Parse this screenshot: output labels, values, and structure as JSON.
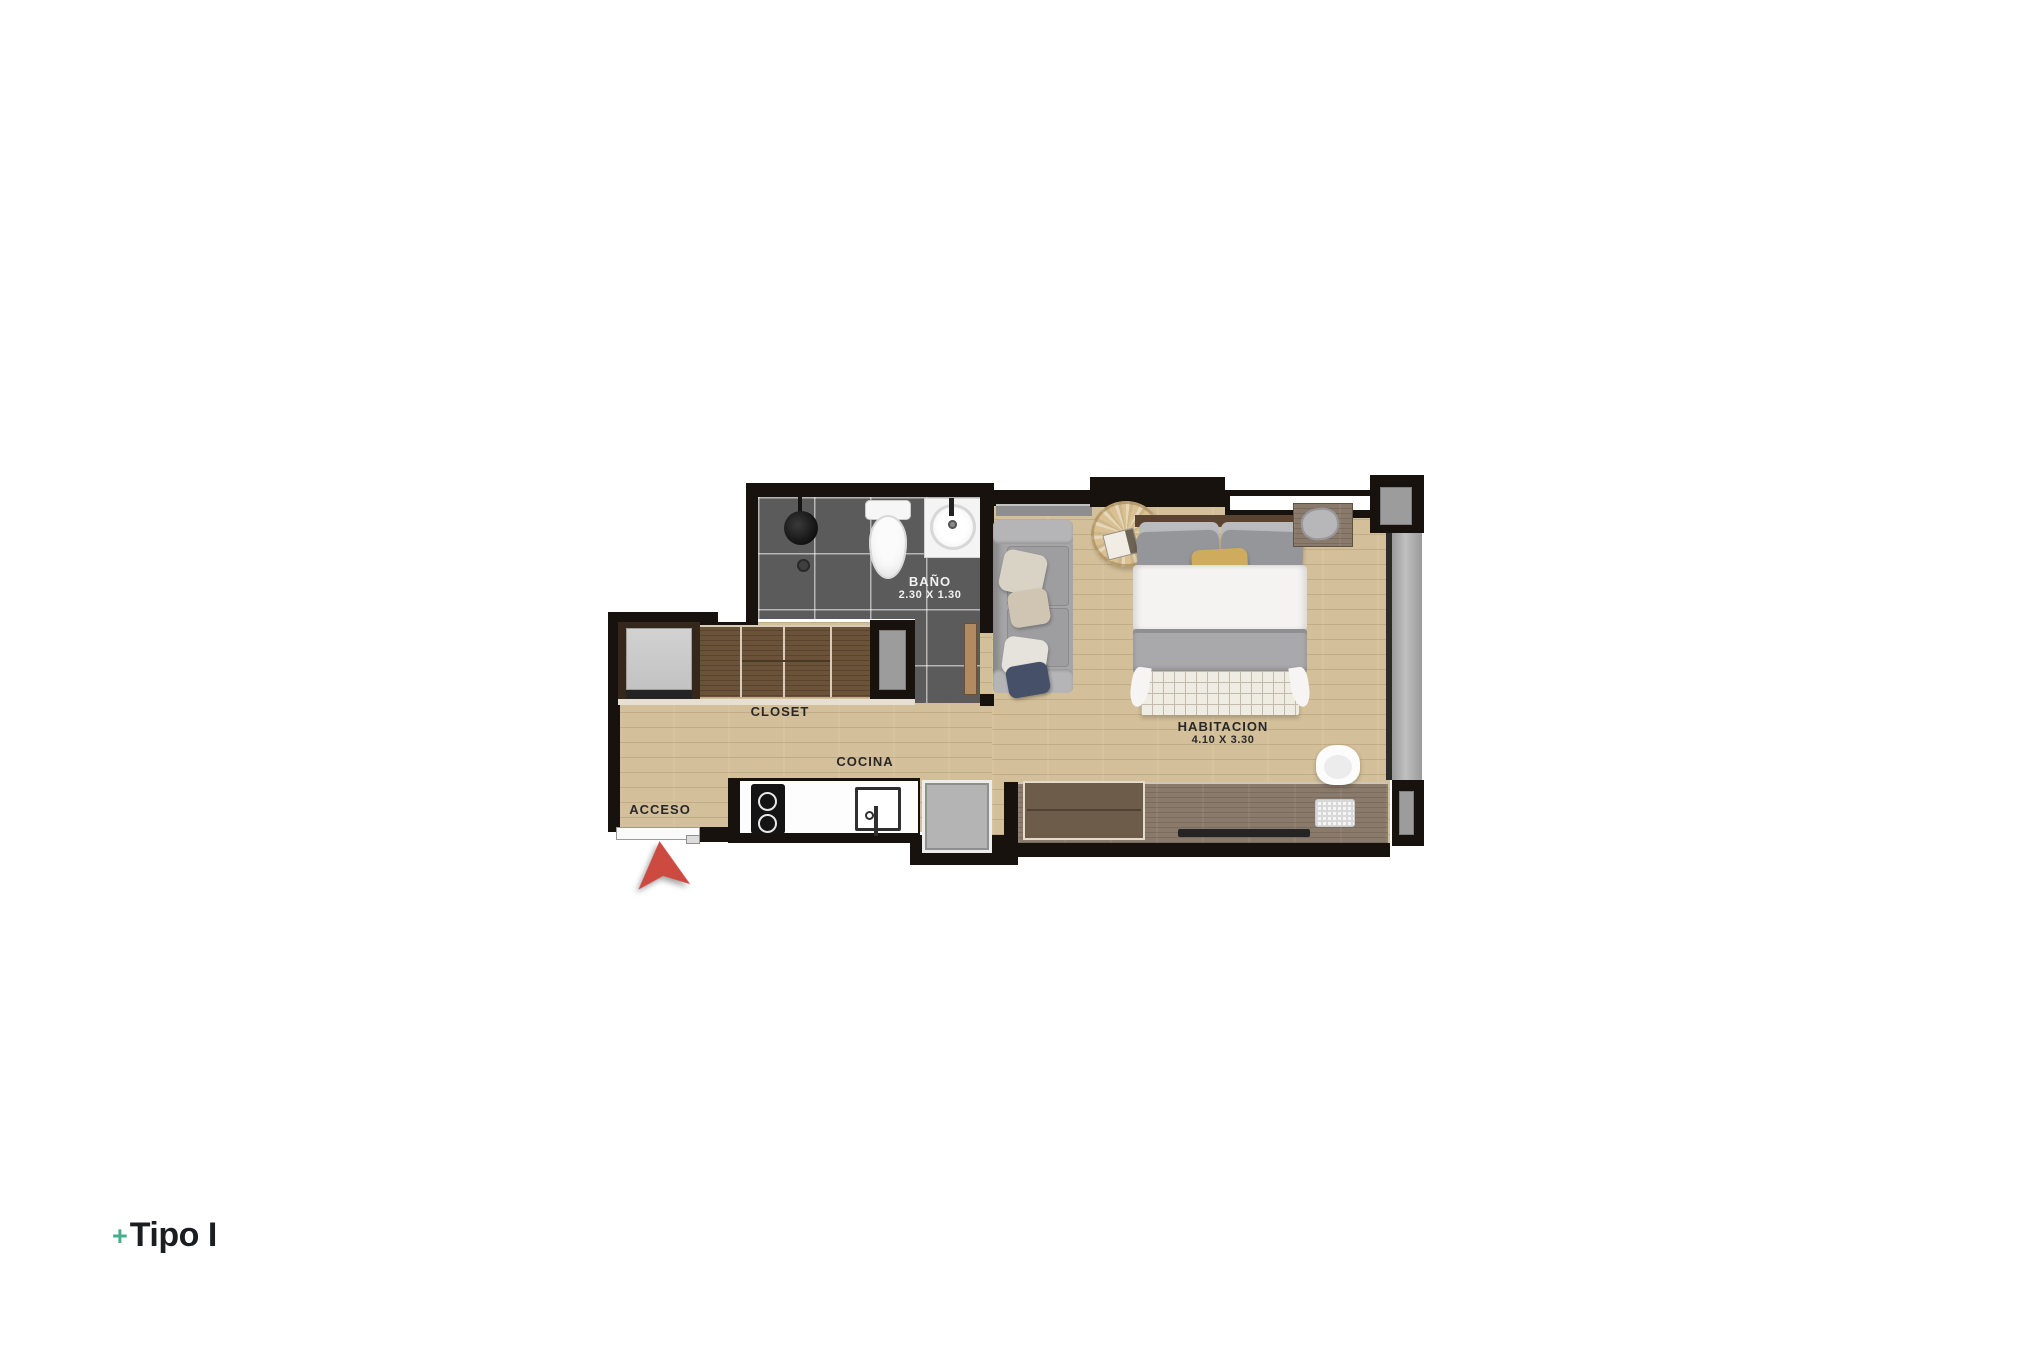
{
  "plan": {
    "labels": {
      "bathroom": {
        "name": "BAÑO",
        "dim": "2.30 X 1.30"
      },
      "closet": {
        "name": "CLOSET"
      },
      "kitchen": {
        "name": "COCINA"
      },
      "access": {
        "name": "ACCESO"
      },
      "bedroom": {
        "name": "HABITACION",
        "dim": "4.10 X 3.30"
      }
    },
    "colors": {
      "wall": "#17120e",
      "tile_gray": "#5b5b5b",
      "wood_floor": "#d3bf99",
      "wood_desk": "#8a7a6b",
      "wood_closet": "#6b5339",
      "window_gray": "#a6a6a6",
      "entry_arrow_red": "#cc4a40",
      "bed_pillow_yellow": "#cfab5d",
      "sofa_gray": "#a6a6a8",
      "accent_teal": "#45b08c"
    }
  },
  "footer": {
    "plus_sign": "+",
    "type_label": "Tipo I"
  }
}
